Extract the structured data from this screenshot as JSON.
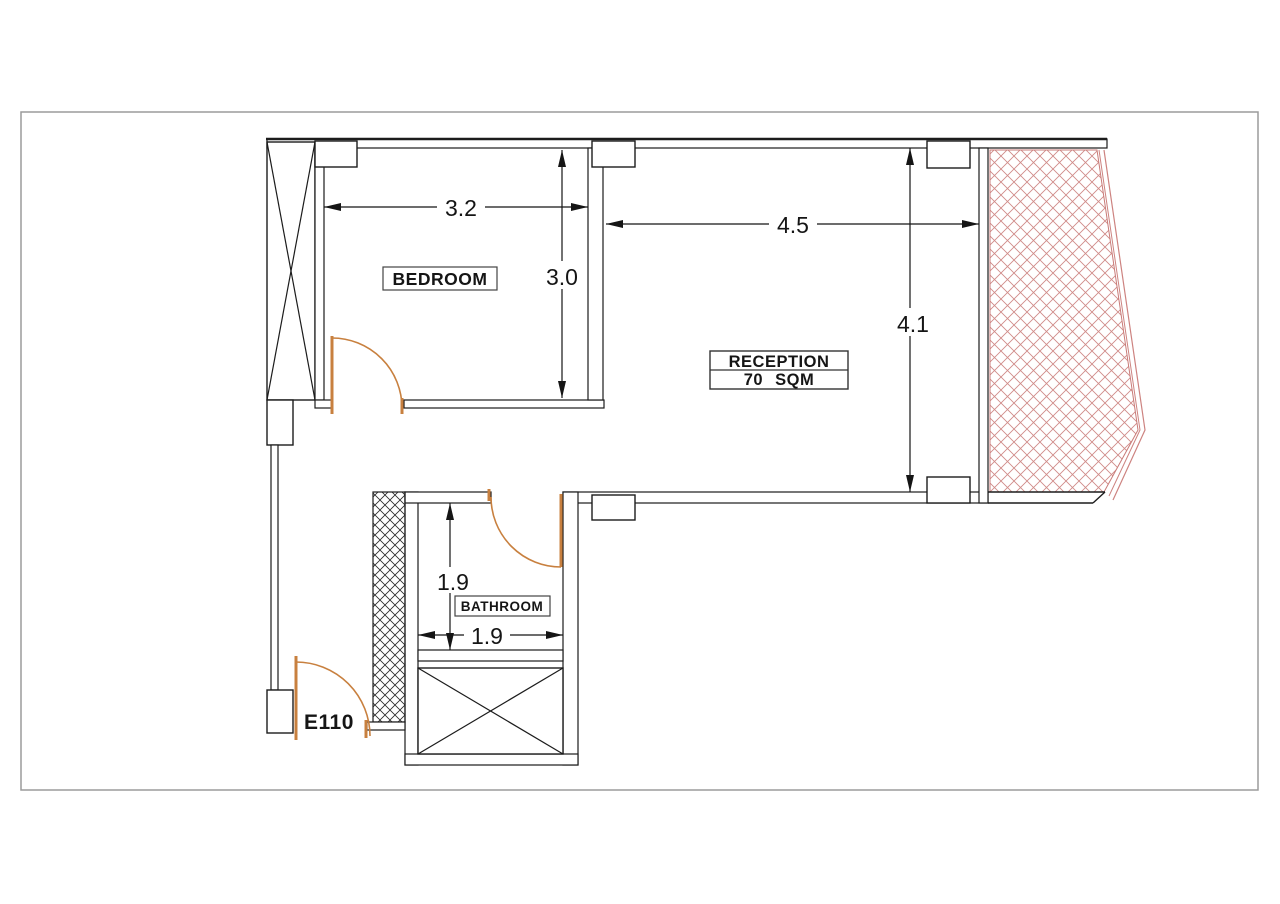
{
  "page": {
    "background": "#ffffff",
    "border_color": "#9b9b9b"
  },
  "colors": {
    "wall": "#1c1c1c",
    "door": "#c8803f",
    "balcony_hatch": "#d08b88",
    "shaft_hatch": "#2a2a2a"
  },
  "labels": {
    "bedroom": "BEDROOM",
    "reception": "RECEPTION",
    "reception_area": "70 SQM",
    "bathroom": "BATHROOM",
    "entry_door": "E110"
  },
  "dimensions": {
    "bedroom_width": "3.2",
    "bedroom_height": "3.0",
    "reception_width": "4.5",
    "reception_height": "4.1",
    "bathroom_width": "1.9",
    "bathroom_height": "1.9"
  }
}
